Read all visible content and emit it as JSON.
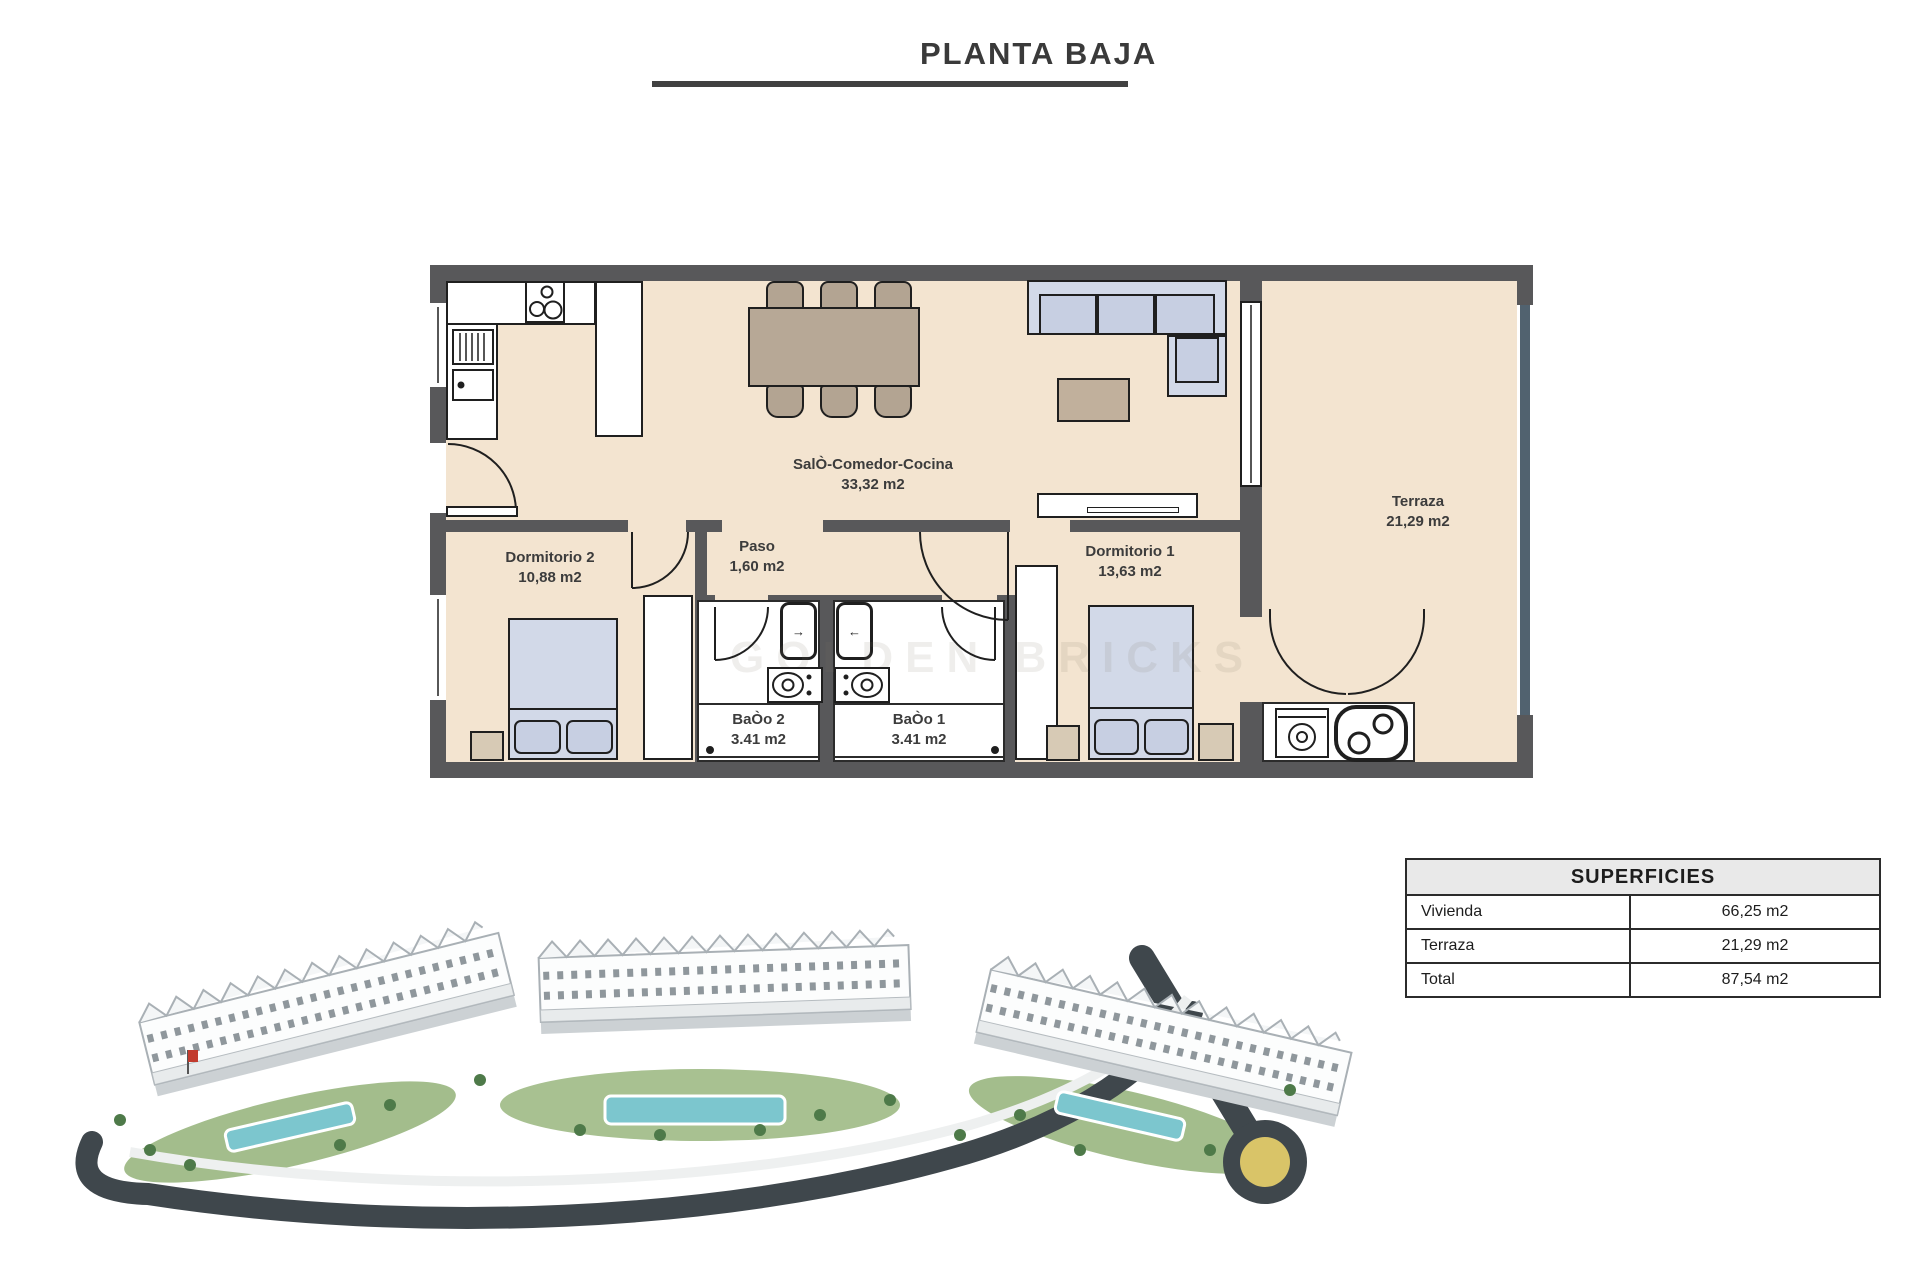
{
  "title": "PLANTA BAJA",
  "floor_plan": {
    "rooms": {
      "salon": {
        "name": "SalÒ-Comedor-Cocina",
        "area": "33,32 m2"
      },
      "dormitorio2": {
        "name": "Dormitorio 2",
        "area": "10,88 m2"
      },
      "paso": {
        "name": "Paso",
        "area": "1,60 m2"
      },
      "dormitorio1": {
        "name": "Dormitorio 1",
        "area": "13,63 m2"
      },
      "bano2": {
        "name": "BaÒo 2",
        "area": "3.41 m2"
      },
      "bano1": {
        "name": "BaÒo 1",
        "area": "3.41 m2"
      },
      "terraza": {
        "name": "Terraza",
        "area": "21,29 m2"
      }
    },
    "shower_arrows": {
      "left": "→",
      "right": "←"
    }
  },
  "watermark": "GOLDEN BRICKS",
  "superficies": {
    "header": "SUPERFICIES",
    "rows": [
      {
        "label": "Vivienda",
        "value": "66,25 m2"
      },
      {
        "label": "Terraza",
        "value": "21,29 m2"
      },
      {
        "label": "Total",
        "value": "87,54 m2"
      }
    ]
  },
  "colors": {
    "wall": "#58585a",
    "floor": "#f3e4d0",
    "furniture_blue": "#d2d9e8",
    "furniture_tan": "#b7a896",
    "window_glass": "#51626f",
    "pool": "#7cc6ce",
    "road": "#3f474c",
    "roundabout_center": "#d9c468",
    "table_header_bg": "#e9e9e9"
  }
}
